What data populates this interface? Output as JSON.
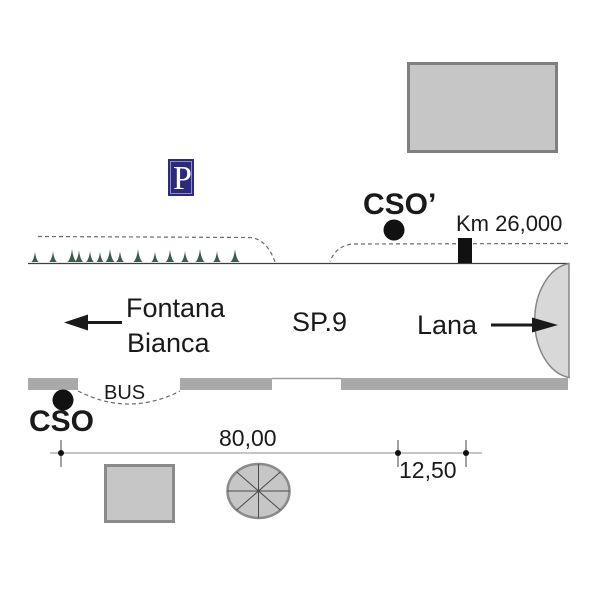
{
  "plan": {
    "road_name": "SP.9",
    "km_marker_label": "Km 26,000",
    "bus_bay_label": "BUS",
    "destination_left": {
      "line1": "Fontana",
      "line2": "Bianca"
    },
    "destination_right": "Lana",
    "stop_upper_label": "CSO’",
    "stop_lower_label": "CSO",
    "parking_sign_label": "P",
    "dimension_main": "80,00",
    "dimension_secondary": "12,50"
  },
  "colors": {
    "background": "#ffffff",
    "ink": "#1a1a1a",
    "parking_bg": "#2d2a7d",
    "parking_border_inner": "#8e8cc0",
    "parking_fg": "#ffffff",
    "tree_green": "#3e5c4e",
    "sidewalk_gray": "#a9a9a9",
    "building_fill": "#c6c6c6",
    "building_border": "#7f7f7f",
    "junction_bulb_fill": "#d8d8d8",
    "junction_bulb_border": "#868686",
    "road_edge_line": "#3f3f3f",
    "dashed_boundary": "#6b6b6b",
    "dimension_line": "#b3b3b3",
    "marker_black": "#111111"
  }
}
